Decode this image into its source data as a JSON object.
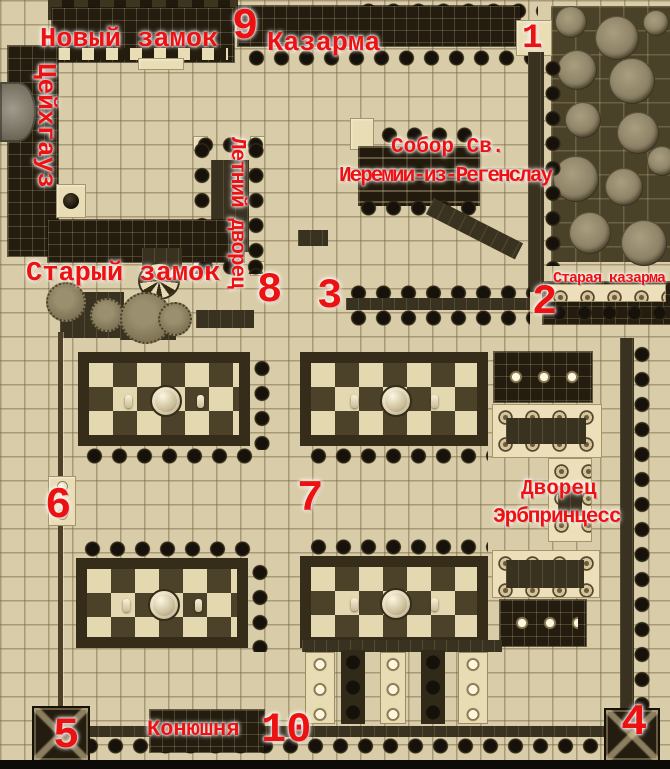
{
  "map": {
    "type": "annotated-game-map",
    "palette": {
      "ground": "#d9cca8",
      "grid_line": "#6d5e3c",
      "building_dark": "#241d0f",
      "hedge_dark": "#3a3220",
      "forest_ground": "#4a4129",
      "tree_olive": "#8d8266",
      "path_light": "#e9ddb5",
      "label_red": "#ed1212",
      "label_glow": "#ffffff"
    },
    "labels": {
      "new_castle": "Новый замок",
      "marker_9": "9",
      "barracks": "Казарма",
      "marker_1": "1",
      "zeughaus": "Цейхгауз",
      "cathedral_line1": "Собор Св.",
      "cathedral_line2": "Иеремии-из-Регенслау",
      "summer_palace": "Летний дворец",
      "old_castle": "Старый замок",
      "marker_8": "8",
      "marker_3": "3",
      "old_barracks": "Старая казарма",
      "marker_2": "2",
      "marker_6": "6",
      "marker_7": "7",
      "palace_line1": "Дворец",
      "palace_line2": "Эрбпринцесс",
      "marker_5": "5",
      "stable": "Конюшня",
      "marker_10": "10",
      "marker_4": "4"
    }
  }
}
